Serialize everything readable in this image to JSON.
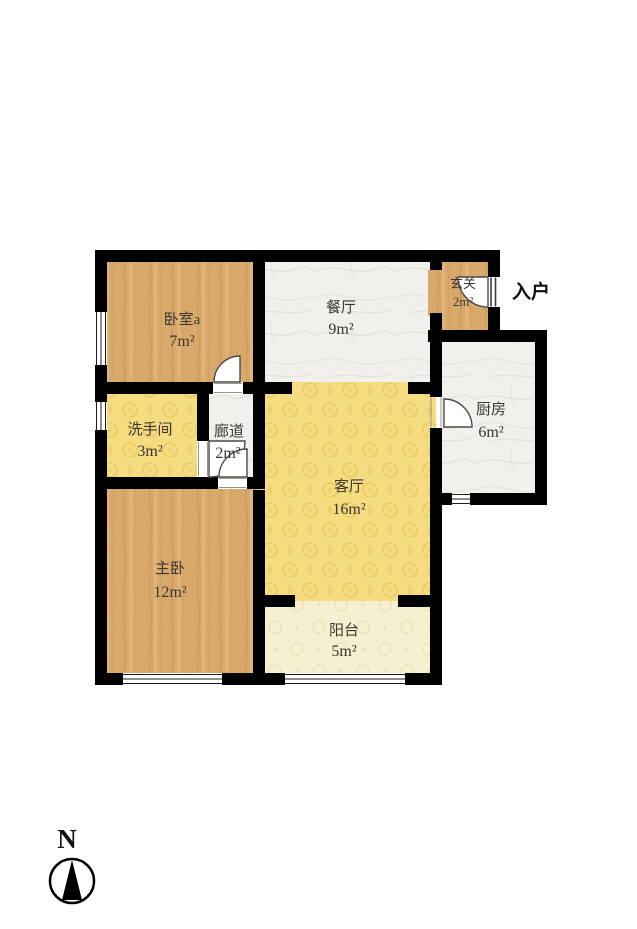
{
  "plan": {
    "type": "apartment-floor-plan",
    "compass_label": "N",
    "entry_label": "入户"
  },
  "rooms": {
    "bedroom_a": {
      "name": "卧室a",
      "area": "7m²"
    },
    "dining": {
      "name": "餐厅",
      "area": "9m²"
    },
    "foyer": {
      "name": "玄关",
      "area": "2m²"
    },
    "kitchen": {
      "name": "厨房",
      "area": "6m²"
    },
    "bathroom": {
      "name": "洗手间",
      "area": "3m²"
    },
    "corridor": {
      "name": "廊道",
      "area": "2m²"
    },
    "living": {
      "name": "客厅",
      "area": "16m²"
    },
    "master_bedroom": {
      "name": "主卧",
      "area": "12m²"
    },
    "balcony": {
      "name": "阳台",
      "area": "5m²"
    }
  },
  "colors": {
    "wall": "#000000",
    "wood": "#d9a96c",
    "marble": "#f2f0ec",
    "yellow": "#f5dc80",
    "cream": "#f6efd0",
    "text": "#3b3833"
  }
}
